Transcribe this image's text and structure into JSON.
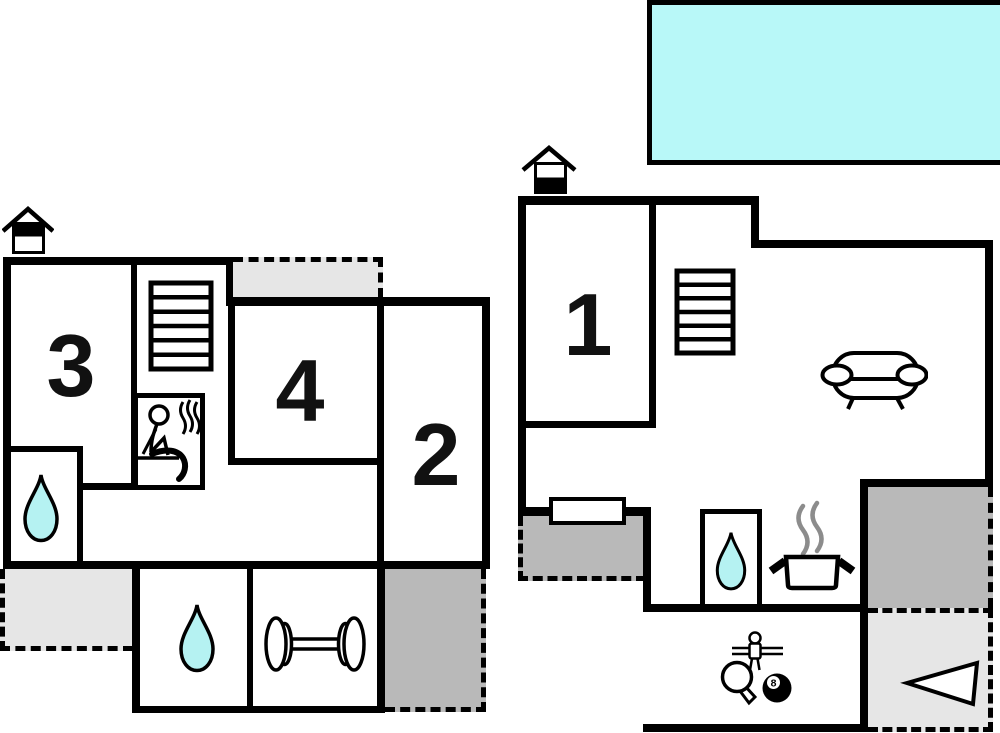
{
  "diagram": {
    "type": "floor-plan",
    "buildings": 2
  },
  "rooms": {
    "r1": {
      "label": "1"
    },
    "r2": {
      "label": "2"
    },
    "r3": {
      "label": "3"
    },
    "r4": {
      "label": "4"
    }
  },
  "game_room": {
    "billiard_ball_label": "8"
  },
  "colors": {
    "wall": "#000000",
    "pool": "#b8f8f8",
    "water": "#b5f2f2",
    "light_gray": "#e6e6e6",
    "dark_gray": "#b9b9b9",
    "steam": "#8c8c8c"
  },
  "icons": {
    "chimney": "chimney-icon",
    "stairs": "stairs-icon",
    "sauna": "sauna-icon",
    "water_drop": "water-drop-icon",
    "dumbbell": "dumbbell-icon",
    "sofa": "sofa-icon",
    "cooking_pot": "pot-steam-icon",
    "foosball": "foosball-player-icon",
    "table_tennis": "table-tennis-paddle-icon",
    "billiard_ball": "eight-ball-icon",
    "arrow": "arrow-triangle-icon"
  }
}
